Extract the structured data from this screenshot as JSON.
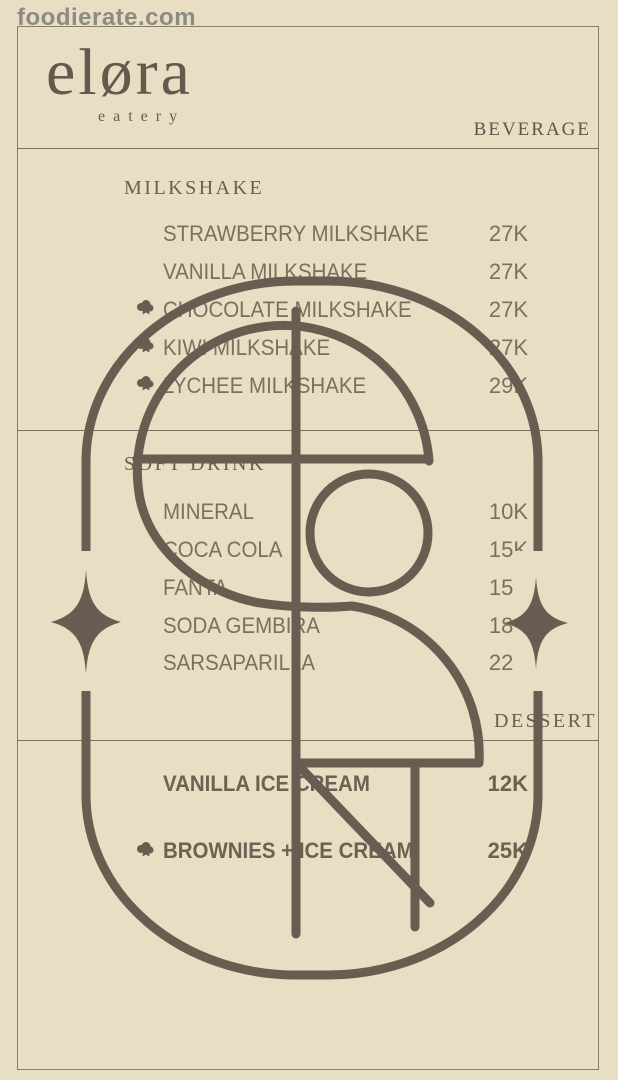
{
  "watermark": "foodierate.com",
  "brand": {
    "name": "eløra",
    "tagline": "eatery"
  },
  "page_label": "BEVERAGE",
  "sections": [
    {
      "title": "MILKSHAKE",
      "items": [
        {
          "name": "STRAWBERRY MILKSHAKE",
          "price": "27K"
        },
        {
          "name": "VANILLA MILKSHAKE",
          "price": "27K"
        },
        {
          "name": "CHOCOLATE MILKSHAKE",
          "price": "27K",
          "marked": true
        },
        {
          "name": "KIWI MILKSHAKE",
          "price": "27K",
          "marked": true
        },
        {
          "name": "LYCHEE MILKSHAKE",
          "price": "29K",
          "marked": true
        }
      ]
    },
    {
      "title": "SOFT DRINK",
      "items": [
        {
          "name": "MINERAL",
          "price": "10K"
        },
        {
          "name": "COCA COLA",
          "price": "15K"
        },
        {
          "name": "FANTA",
          "price": "15K"
        },
        {
          "name": "SODA GEMBIRA",
          "price": "18K"
        },
        {
          "name": "SARSAPARILLA",
          "price": "22K"
        }
      ]
    },
    {
      "title": "DESSERT",
      "items": [
        {
          "name": "VANILLA ICE CREAM",
          "price": "12K"
        },
        {
          "name": "BROWNIES + ICE CREAM",
          "price": "25K",
          "marked": true
        }
      ]
    }
  ],
  "colors": {
    "background": "#e7dec4",
    "ink": "#6a5c50",
    "text": "#7e6e5e",
    "frame": "#8a7c68",
    "watermark": "#7d7c75"
  }
}
